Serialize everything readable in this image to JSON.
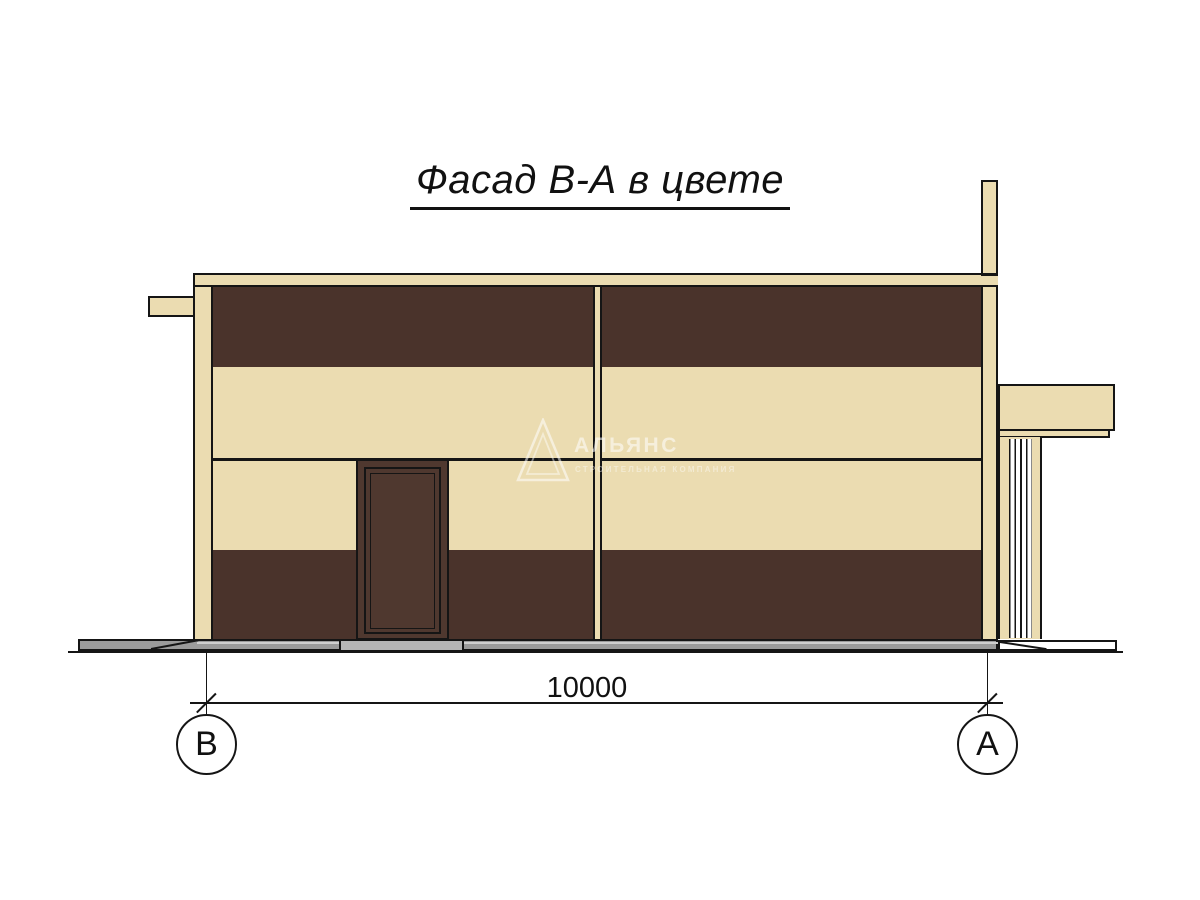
{
  "palette": {
    "paper": "#ffffff",
    "cream": "#ebdcb1",
    "brown": "#4a332b",
    "door_brown": "#4f382f",
    "plinth_gray": "#9b9b9b",
    "step_gray": "#b5b5b5",
    "outline": "#151515"
  },
  "title": {
    "text": "Фасад В-А в цвете"
  },
  "dimension": {
    "value": "10000"
  },
  "axes": {
    "left": "В",
    "right": "А"
  },
  "watermark": {
    "name": "АЛЬЯНС",
    "tagline": "СТРОИТЕЛЬНАЯ КОМПАНИЯ",
    "logo": "pyramid-icon"
  }
}
